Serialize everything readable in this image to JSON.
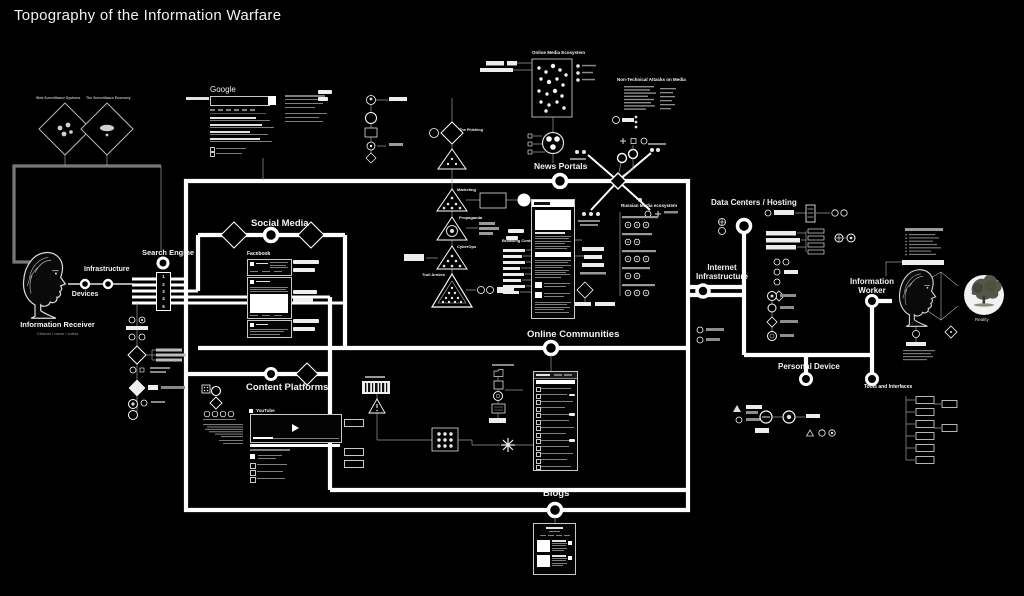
{
  "title": "Topography of the Information Warfare",
  "colors": {
    "background": "#000000",
    "line": "#ffffff",
    "dim": "#8a8a8a"
  },
  "receiver": {
    "label": "Information Receiver",
    "sub": "Citizens / users / voters"
  },
  "nodes": {
    "devices": "Devices",
    "infrastructure": "Infrastructure",
    "search_engine": "Search Engine",
    "internet_infrastructure": "Internet Infrastructure",
    "data_centers": "Data Centers / Hosting",
    "personal_device": "Personal Device",
    "tools_interfaces": "Tools and Interfaces"
  },
  "sections": {
    "social_media": "Social Media",
    "news_portals": "News Portals",
    "online_communities": "Online Communities",
    "content_platforms": "Content Platforms",
    "blogs": "Blogs",
    "online_media_ecosystem": "Online Media Ecosystem",
    "non_technical_attacks": "Non-Technical Attacks on Media",
    "russian_media_ecosystem": "Russian Media ecosystem",
    "browsing_context": "Browsing Context"
  },
  "attacks": {
    "phishing": "The Phishing",
    "marketing": "Marketing",
    "propaganda": "Propaganda",
    "cyberops": "CyberOps",
    "troll_armies": "Troll Armies"
  },
  "surveillance": {
    "left": "Web Surveillance Systems",
    "right": "The Surveillance Economy"
  },
  "platforms": {
    "google": "Google",
    "facebook": "Facebook",
    "youtube": "YouTube"
  },
  "worker": {
    "label": "Information Worker",
    "reality": "Reality"
  },
  "search_engine_results": [
    "1",
    "2",
    "3",
    "4",
    "5"
  ]
}
